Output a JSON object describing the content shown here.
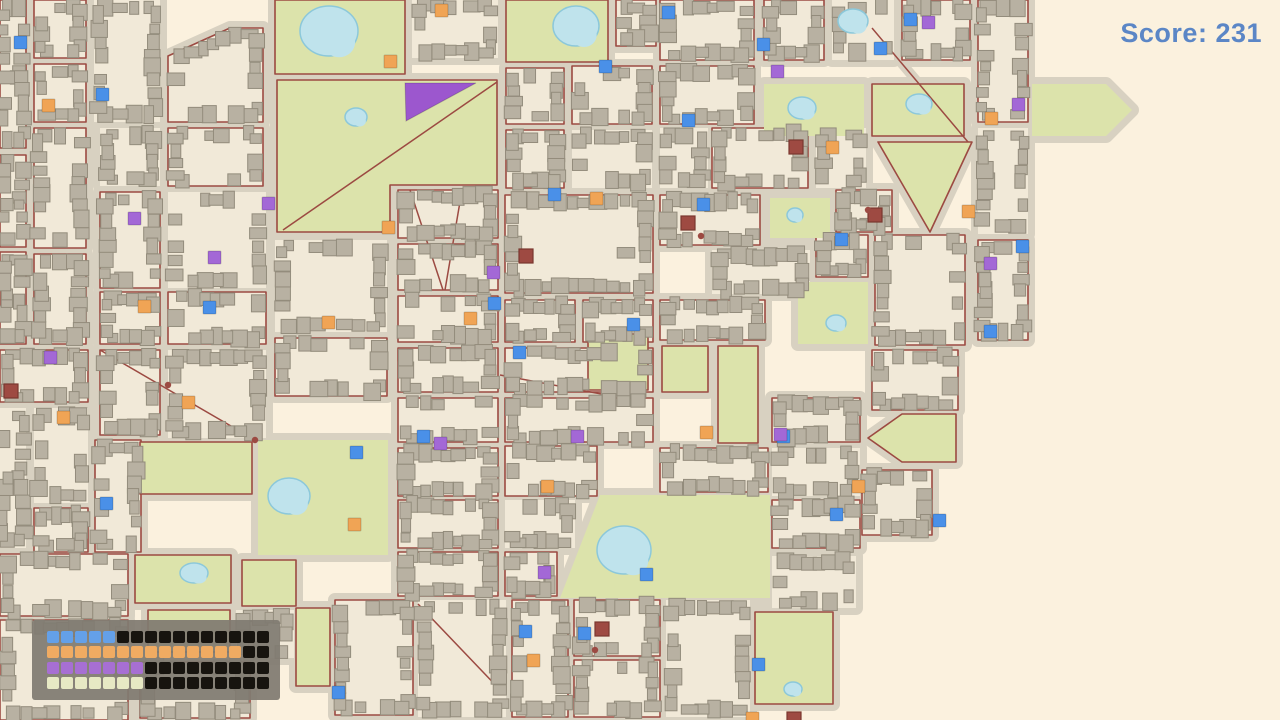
{
  "hud": {
    "score_label": "Score: 231",
    "score_color": "#5b86c6"
  },
  "progress_panel": {
    "panel_color": "rgba(128,123,113,0.93)",
    "empty_color": "#17140f",
    "rows": [
      {
        "name": "blue",
        "color": "#64a0e8",
        "filled": 5,
        "total": 16
      },
      {
        "name": "orange",
        "color": "#f0ab62",
        "filled": 14,
        "total": 16
      },
      {
        "name": "purple",
        "color": "#a76fd3",
        "filled": 7,
        "total": 16
      },
      {
        "name": "cream",
        "color": "#e7e9c4",
        "filled": 7,
        "total": 16
      }
    ]
  },
  "map": {
    "width": 1280,
    "height": 720,
    "colors": {
      "background": "#fbf1de",
      "road": "#d8d1c1",
      "road_line": "#9c4a42",
      "block": "#f1e9d8",
      "park": "#dce3ab",
      "building": "#b8b1a2",
      "building_stroke": "#938c7c",
      "pond": "#bfe3ec",
      "pond_stroke": "#8cc8da",
      "special_blue": "#4a90e8",
      "special_orange": "#f0a455",
      "special_purple": "#a368d6",
      "special_red": "#9e4a42",
      "special_red_stroke": "#7a372f",
      "purple_zone": "#9c57ce"
    },
    "district_rects": [
      [
        0,
        0,
        26,
        148
      ],
      [
        34,
        0,
        52,
        58
      ],
      [
        94,
        0,
        66,
        122
      ],
      [
        412,
        0,
        86,
        58
      ],
      [
        616,
        0,
        40,
        46
      ],
      [
        660,
        0,
        94,
        60
      ],
      [
        764,
        0,
        60,
        60
      ],
      [
        832,
        0,
        62,
        60
      ],
      [
        902,
        0,
        68,
        60
      ],
      [
        978,
        0,
        50,
        122
      ],
      [
        34,
        64,
        52,
        58
      ],
      [
        0,
        155,
        26,
        92
      ],
      [
        100,
        128,
        60,
        58
      ],
      [
        168,
        128,
        95,
        58
      ],
      [
        506,
        68,
        58,
        56
      ],
      [
        572,
        66,
        80,
        58
      ],
      [
        660,
        66,
        94,
        58
      ],
      [
        506,
        130,
        58,
        58
      ],
      [
        572,
        130,
        80,
        58
      ],
      [
        660,
        128,
        48,
        60
      ],
      [
        712,
        128,
        96,
        60
      ],
      [
        816,
        128,
        50,
        60
      ],
      [
        978,
        128,
        50,
        106
      ],
      [
        978,
        240,
        50,
        100
      ],
      [
        34,
        128,
        52,
        120
      ],
      [
        34,
        254,
        52,
        90
      ],
      [
        0,
        252,
        26,
        92
      ],
      [
        100,
        192,
        60,
        96
      ],
      [
        168,
        192,
        98,
        96
      ],
      [
        275,
        240,
        112,
        92
      ],
      [
        398,
        190,
        100,
        48
      ],
      [
        398,
        244,
        100,
        46
      ],
      [
        398,
        296,
        100,
        46
      ],
      [
        505,
        195,
        148,
        98
      ],
      [
        660,
        195,
        100,
        50
      ],
      [
        712,
        250,
        98,
        44
      ],
      [
        875,
        235,
        90,
        110
      ],
      [
        836,
        190,
        56,
        42
      ],
      [
        816,
        235,
        52,
        42
      ],
      [
        0,
        350,
        88,
        52
      ],
      [
        0,
        408,
        26,
        140
      ],
      [
        34,
        408,
        54,
        95
      ],
      [
        95,
        440,
        46,
        112
      ],
      [
        100,
        292,
        60,
        52
      ],
      [
        168,
        292,
        98,
        52
      ],
      [
        275,
        338,
        112,
        58
      ],
      [
        168,
        350,
        98,
        88
      ],
      [
        100,
        350,
        60,
        85
      ],
      [
        398,
        348,
        100,
        44
      ],
      [
        398,
        398,
        100,
        44
      ],
      [
        505,
        300,
        70,
        42
      ],
      [
        583,
        300,
        70,
        42
      ],
      [
        660,
        300,
        105,
        40
      ],
      [
        505,
        348,
        148,
        44
      ],
      [
        505,
        398,
        148,
        44
      ],
      [
        772,
        398,
        88,
        44
      ],
      [
        872,
        350,
        86,
        60
      ],
      [
        772,
        448,
        88,
        48
      ],
      [
        772,
        500,
        88,
        48
      ],
      [
        862,
        470,
        70,
        65
      ],
      [
        505,
        446,
        92,
        50
      ],
      [
        398,
        448,
        100,
        48
      ],
      [
        398,
        500,
        100,
        48
      ],
      [
        505,
        500,
        70,
        48
      ],
      [
        505,
        552,
        52,
        44
      ],
      [
        398,
        552,
        100,
        44
      ],
      [
        660,
        448,
        108,
        44
      ],
      [
        236,
        610,
        58,
        48
      ],
      [
        335,
        600,
        78,
        115
      ],
      [
        418,
        600,
        88,
        117
      ],
      [
        512,
        600,
        56,
        117
      ],
      [
        574,
        600,
        86,
        56
      ],
      [
        574,
        660,
        86,
        57
      ],
      [
        666,
        600,
        84,
        117
      ],
      [
        772,
        556,
        84,
        52
      ],
      [
        34,
        508,
        54,
        44
      ],
      [
        0,
        554,
        128,
        62
      ],
      [
        0,
        620,
        128,
        100
      ],
      [
        140,
        662,
        110,
        56
      ]
    ],
    "district_polys": [
      [
        [
          230,
          28
        ],
        [
          263,
          28
        ],
        [
          263,
          122
        ],
        [
          168,
          122
        ],
        [
          168,
          56
        ]
      ]
    ],
    "park_rects": [
      [
        275,
        0,
        130,
        74
      ],
      [
        506,
        0,
        102,
        62
      ],
      [
        764,
        84,
        100,
        52
      ],
      [
        872,
        84,
        92,
        52
      ],
      [
        798,
        282,
        70,
        62
      ],
      [
        662,
        346,
        46,
        46
      ],
      [
        718,
        346,
        40,
        97
      ],
      [
        588,
        334,
        60,
        56
      ],
      [
        140,
        442,
        112,
        52
      ],
      [
        258,
        440,
        130,
        115
      ],
      [
        135,
        555,
        96,
        48
      ],
      [
        242,
        560,
        54,
        46
      ],
      [
        148,
        610,
        82,
        42
      ],
      [
        296,
        608,
        34,
        78
      ],
      [
        755,
        612,
        78,
        92
      ],
      [
        770,
        198,
        60,
        40
      ]
    ],
    "park_polys": [
      [
        [
          277,
          80
        ],
        [
          497,
          80
        ],
        [
          497,
          185
        ],
        [
          390,
          185
        ],
        [
          390,
          232
        ],
        [
          277,
          232
        ]
      ],
      [
        [
          1032,
          84
        ],
        [
          1106,
          84
        ],
        [
          1132,
          110
        ],
        [
          1106,
          136
        ],
        [
          1032,
          136
        ]
      ],
      [
        [
          878,
          142
        ],
        [
          972,
          142
        ],
        [
          930,
          232
        ]
      ],
      [
        [
          600,
          495
        ],
        [
          770,
          495
        ],
        [
          770,
          598
        ],
        [
          560,
          598
        ]
      ],
      [
        [
          868,
          438
        ],
        [
          902,
          414
        ],
        [
          956,
          414
        ],
        [
          956,
          462
        ],
        [
          902,
          462
        ]
      ]
    ],
    "road_segments": [
      [
        497,
        82,
        283,
        230
      ],
      [
        872,
        28,
        968,
        142
      ],
      [
        100,
        350,
        255,
        440
      ],
      [
        418,
        604,
        504,
        694
      ],
      [
        410,
        190,
        443,
        290
      ],
      [
        462,
        190,
        445,
        290
      ],
      [
        500,
        375,
        612,
        396
      ]
    ],
    "ponds": [
      [
        329,
        31,
        29,
        25
      ],
      [
        356,
        117,
        11,
        9
      ],
      [
        576,
        26,
        23,
        20
      ],
      [
        853,
        21,
        15,
        12
      ],
      [
        802,
        108,
        14,
        11
      ],
      [
        919,
        104,
        13,
        10
      ],
      [
        795,
        215,
        8,
        7
      ],
      [
        836,
        323,
        10,
        8
      ],
      [
        289,
        496,
        21,
        18
      ],
      [
        194,
        573,
        14,
        10
      ],
      [
        624,
        550,
        27,
        24
      ],
      [
        793,
        689,
        9,
        7
      ]
    ],
    "purple_zone_triangle": [
      [
        405,
        83
      ],
      [
        476,
        83
      ],
      [
        406,
        121
      ]
    ],
    "specials": {
      "blue": [
        [
          96,
          88
        ],
        [
          14,
          36
        ],
        [
          757,
          38
        ],
        [
          874,
          42
        ],
        [
          904,
          13
        ],
        [
          599,
          60
        ],
        [
          662,
          6
        ],
        [
          682,
          114
        ],
        [
          548,
          188
        ],
        [
          835,
          233
        ],
        [
          1016,
          240
        ],
        [
          984,
          325
        ],
        [
          203,
          301
        ],
        [
          513,
          346
        ],
        [
          488,
          297
        ],
        [
          627,
          318
        ],
        [
          417,
          430
        ],
        [
          777,
          430
        ],
        [
          830,
          508
        ],
        [
          100,
          497
        ],
        [
          519,
          625
        ],
        [
          752,
          658
        ],
        [
          332,
          686
        ],
        [
          578,
          627
        ],
        [
          697,
          198
        ],
        [
          933,
          514
        ],
        [
          350,
          446
        ],
        [
          640,
          568
        ]
      ],
      "orange": [
        [
          42,
          99
        ],
        [
          138,
          300
        ],
        [
          384,
          55
        ],
        [
          382,
          221
        ],
        [
          464,
          312
        ],
        [
          590,
          192
        ],
        [
          826,
          141
        ],
        [
          852,
          480
        ],
        [
          57,
          411
        ],
        [
          435,
          4
        ],
        [
          527,
          654
        ],
        [
          348,
          518
        ],
        [
          746,
          712
        ],
        [
          322,
          316
        ],
        [
          182,
          396
        ],
        [
          541,
          480
        ],
        [
          985,
          112
        ],
        [
          962,
          205
        ],
        [
          700,
          426
        ]
      ],
      "purple": [
        [
          771,
          65
        ],
        [
          1012,
          98
        ],
        [
          262,
          197
        ],
        [
          984,
          257
        ],
        [
          128,
          212
        ],
        [
          44,
          351
        ],
        [
          487,
          266
        ],
        [
          538,
          566
        ],
        [
          434,
          437
        ],
        [
          208,
          251
        ],
        [
          571,
          430
        ],
        [
          774,
          428
        ],
        [
          922,
          16
        ]
      ],
      "red": [
        [
          4,
          384
        ],
        [
          519,
          249
        ],
        [
          681,
          216
        ],
        [
          789,
          140
        ],
        [
          595,
          622
        ],
        [
          787,
          712
        ],
        [
          868,
          208
        ]
      ]
    },
    "road_nodes": [
      [
        701,
        236
      ],
      [
        255,
        440
      ],
      [
        595,
        650
      ],
      [
        868,
        210
      ],
      [
        168,
        385
      ]
    ]
  }
}
